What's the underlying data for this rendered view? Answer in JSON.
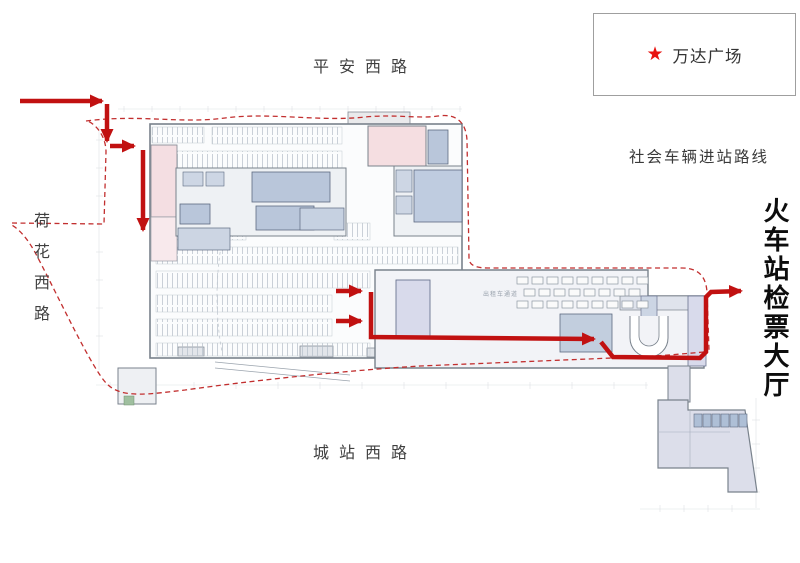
{
  "legend": {
    "star_icon": "★",
    "label": "万达广场"
  },
  "roads": {
    "top": "平安西路",
    "left": "荷花西路",
    "bottom": "城站西路"
  },
  "notes": {
    "route_label": "社会车辆进站路线"
  },
  "destination": {
    "label": "火车站检票大厅"
  },
  "plan_labels": {
    "taxi_lane": "出租车通道"
  }
}
